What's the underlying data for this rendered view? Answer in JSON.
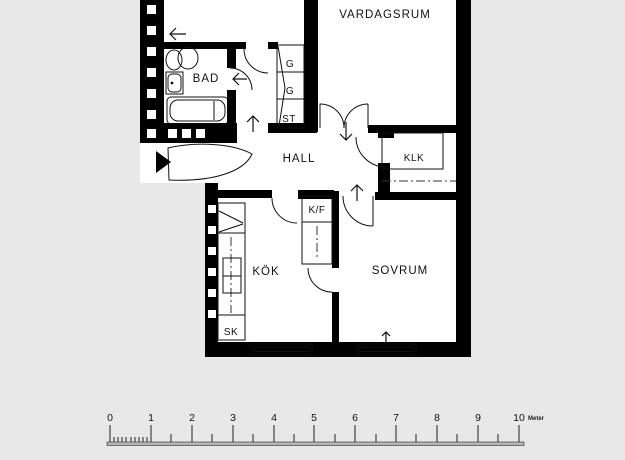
{
  "background": "#e8e8e8",
  "plan": {
    "wall_color": "#000000",
    "floor_color": "#ffffff",
    "labels": {
      "vardagsrum": "VARDAGSRUM",
      "bad": "BAD",
      "hall": "HALL",
      "klk": "KLK",
      "kok": "KÖK",
      "sovrum": "SOVRUM",
      "closet_g1": "G",
      "closet_g2": "G",
      "closet_st": "ST",
      "fridge_freezer": "K/F",
      "cabinet_sk": "SK"
    }
  },
  "scale_bar": {
    "numbers": [
      "0",
      "1",
      "2",
      "3",
      "4",
      "5",
      "6",
      "7",
      "8",
      "9",
      "10"
    ],
    "unit": "Meter"
  }
}
